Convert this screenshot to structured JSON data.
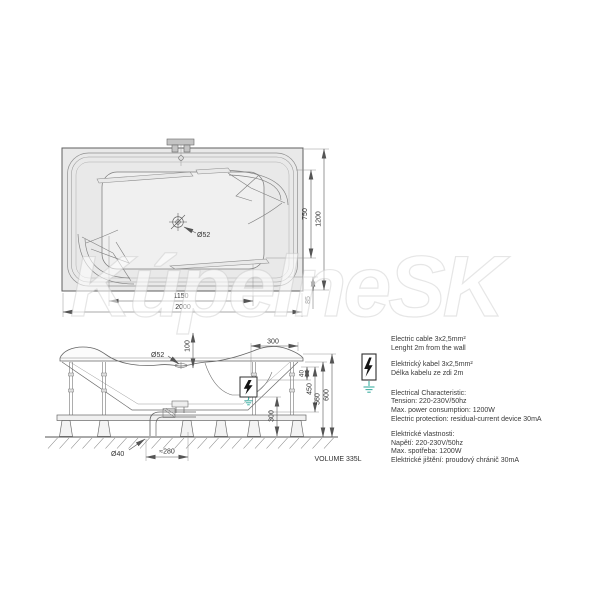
{
  "watermark": "KúpelneSK",
  "colors": {
    "accent_teal": "#3fafa3",
    "line": "#5f5f5f",
    "fill": "#e9e9e9"
  },
  "top_view": {
    "drain_label": "Ø52",
    "dims": {
      "inner_width": "1150",
      "total_width": "2000",
      "inner_length": "750",
      "total_length": "1200",
      "edge_offset": "85"
    }
  },
  "side_view": {
    "drain_label": "Ø52",
    "pipe_label": "Ø40",
    "dims": {
      "drain_inset": "100",
      "unit_width": "300",
      "rim_drop": "40",
      "mid_height": "450",
      "frame_height": "560",
      "total_height": "600",
      "clearance": "300",
      "trap_offset": "≈280"
    },
    "volume_label": "VOLUME 335L"
  },
  "electrical": {
    "en_cable": [
      "Electric cable 3x2,5mm²",
      "Lenght 2m from the wall"
    ],
    "cz_cable": [
      "Elektrický kabel 3x2,5mm²",
      "Délka kabelu ze zdi 2m"
    ],
    "en_spec": [
      "Electrical Characteristic:",
      "Tension: 220-230V/50hz",
      "Max. power consumption: 1200W",
      "Electric protection: residual-current device 30mA"
    ],
    "cz_spec": [
      "Elektrické vlastnosti:",
      "Napětí: 220-230V/50hz",
      "Max. spotřeba: 1200W",
      "Elektrické jištění: proudový chránič 30mA"
    ]
  }
}
